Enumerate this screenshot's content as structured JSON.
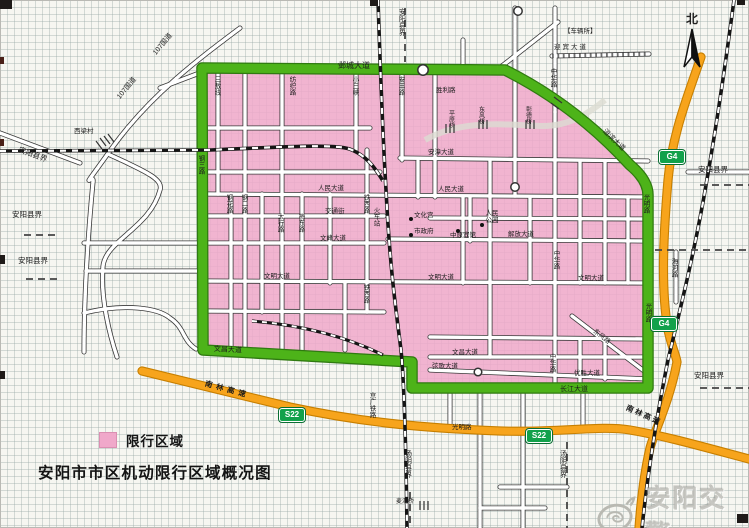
{
  "title": "安阳市市区机动限行区域概况图",
  "legend": {
    "label": "限行区域"
  },
  "watermark": {
    "text": "安阳交警"
  },
  "compass": {
    "label": "北"
  },
  "colors": {
    "restricted_pink": "#F0A8CA",
    "boundary_green": "#4DB319",
    "highway_orange": "#F7A41C",
    "shield_green": "#12A14B",
    "paper": "#F6F6F1"
  },
  "map": {
    "labels": [
      {
        "t": "邺城大道",
        "x": 338,
        "y": 62,
        "s": 8,
        "n": "road-label-yecheng-avenue"
      },
      {
        "t": "钢三路",
        "x": 197,
        "y": 155,
        "s": 6.5,
        "v": 1,
        "n": "road-label-gangsan-road"
      },
      {
        "t": "文昌大道",
        "x": 214,
        "y": 346,
        "s": 7,
        "r": 3,
        "n": "road-label-wenchang-avenue-west"
      },
      {
        "t": "长江大道",
        "x": 560,
        "y": 386,
        "s": 7,
        "n": "road-label-changjiang-avenue"
      },
      {
        "t": "光明路",
        "x": 642,
        "y": 194,
        "s": 6.5,
        "v": 1,
        "n": "road-label-guangming-road"
      },
      {
        "t": "光明路",
        "x": 644,
        "y": 303,
        "s": 6.5,
        "v": 1,
        "n": "road-label-guangming-road"
      },
      {
        "t": "洹滨大道",
        "x": 606,
        "y": 128,
        "s": 7,
        "r": 44,
        "n": "road-label-huanbin-avenue"
      },
      {
        "t": "三敖线",
        "x": 213,
        "y": 76,
        "s": 6.5,
        "v": 1,
        "n": "road-label-sanao-line"
      },
      {
        "t": "纺织路",
        "x": 288,
        "y": 76,
        "s": 6.5,
        "v": 1,
        "n": "road-label-fangzhi-road"
      },
      {
        "t": "小三峡",
        "x": 351,
        "y": 76,
        "s": 6.5,
        "v": 1,
        "n": "road-label-xiaosanxia"
      },
      {
        "t": "安丰路",
        "x": 397,
        "y": 76,
        "s": 6.5,
        "v": 1,
        "n": "road-label-anfeng-road"
      },
      {
        "t": "胜利路",
        "x": 436,
        "y": 87,
        "s": 6.5,
        "n": "road-label-shengli-road"
      },
      {
        "t": "中华路",
        "x": 549,
        "y": 68,
        "s": 6.5,
        "v": 1,
        "n": "road-label-zhonghua-road"
      },
      {
        "t": "中华路",
        "x": 552,
        "y": 250,
        "s": 6.5,
        "v": 1,
        "n": "road-label-zhonghua-road"
      },
      {
        "t": "中华路",
        "x": 548,
        "y": 353,
        "s": 6.5,
        "v": 1,
        "n": "road-label-zhonghua-road"
      },
      {
        "t": "铁西路",
        "x": 362,
        "y": 194,
        "s": 6.5,
        "v": 1,
        "n": "road-label-tiexi-road"
      },
      {
        "t": "铁西路",
        "x": 362,
        "y": 284,
        "s": 6.5,
        "v": 1,
        "n": "road-label-tiexi-road"
      },
      {
        "t": "太行路",
        "x": 276,
        "y": 213,
        "s": 6.5,
        "v": 1,
        "n": "road-label-taihang-road"
      },
      {
        "t": "梅东路",
        "x": 297,
        "y": 213,
        "s": 6.5,
        "v": 1,
        "n": "road-label-meidong-road"
      },
      {
        "t": "钢花路",
        "x": 225,
        "y": 194,
        "s": 6.5,
        "v": 1,
        "n": "road-label-ganghua-road"
      },
      {
        "t": "钢二路",
        "x": 240,
        "y": 194,
        "s": 6.5,
        "v": 1,
        "n": "road-label-ganger-road"
      },
      {
        "t": "安漳大道",
        "x": 428,
        "y": 149,
        "s": 6.5,
        "n": "road-label-anzhang-avenue"
      },
      {
        "t": "人民大道",
        "x": 438,
        "y": 186,
        "s": 6.5,
        "n": "road-label-renmin-avenue"
      },
      {
        "t": "人民大道",
        "x": 318,
        "y": 185,
        "s": 6.5,
        "n": "road-label-renmin-avenue"
      },
      {
        "t": "交通街",
        "x": 325,
        "y": 208,
        "s": 6.5,
        "n": "road-label-jiaotong-street"
      },
      {
        "t": "文峰大道",
        "x": 320,
        "y": 235,
        "s": 6.5,
        "n": "road-label-wenfeng-avenue"
      },
      {
        "t": "解放大道",
        "x": 508,
        "y": 231,
        "s": 6.5,
        "n": "road-label-jiefang-avenue"
      },
      {
        "t": "文明大道",
        "x": 264,
        "y": 273,
        "s": 6.5,
        "n": "road-label-wenming-avenue"
      },
      {
        "t": "文明大道",
        "x": 428,
        "y": 274,
        "s": 6.5,
        "n": "road-label-wenming-avenue"
      },
      {
        "t": "文明大道",
        "x": 578,
        "y": 275,
        "s": 6.5,
        "n": "road-label-wenming-avenue"
      },
      {
        "t": "文昌大道",
        "x": 452,
        "y": 349,
        "s": 6.5,
        "n": "road-label-wenchang-avenue"
      },
      {
        "t": "弦歌大道",
        "x": 432,
        "y": 363,
        "s": 6.5,
        "n": "road-label-xiange-avenue"
      },
      {
        "t": "优胜大道",
        "x": 574,
        "y": 370,
        "s": 6.5,
        "n": "road-label-yousheng-avenue"
      },
      {
        "t": "东风路",
        "x": 596,
        "y": 328,
        "s": 6.5,
        "r": 38,
        "n": "road-label-dongfeng-road"
      },
      {
        "t": "文化宫",
        "x": 414,
        "y": 212,
        "s": 6.5,
        "n": "poi-label-cultural-palace"
      },
      {
        "t": "市政府",
        "x": 414,
        "y": 228,
        "s": 6.5,
        "n": "poi-label-city-hall"
      },
      {
        "t": "中原宾馆",
        "x": 450,
        "y": 232,
        "s": 6.5,
        "n": "poi-label-zhongyuan-hotel"
      },
      {
        "t": "人民\n公园",
        "x": 484,
        "y": 210,
        "s": 6.5,
        "pre": 1,
        "n": "poi-label-peoples-park"
      },
      {
        "t": "火车站",
        "x": 372,
        "y": 207,
        "s": 6.5,
        "v": 1,
        "n": "poi-label-railway-station"
      },
      {
        "t": "海河路",
        "x": 670,
        "y": 258,
        "s": 6.5,
        "v": 1,
        "n": "road-label-haihe-road"
      },
      {
        "t": "107国道",
        "x": 152,
        "y": 52,
        "s": 7,
        "r": -50,
        "n": "road-label-g107"
      },
      {
        "t": "107国道",
        "x": 116,
        "y": 96,
        "s": 7,
        "r": -50,
        "n": "road-label-g107"
      },
      {
        "t": "西梁村",
        "x": 74,
        "y": 128,
        "s": 6.5,
        "n": "village-label-xiliangcun"
      },
      {
        "t": "安阳县界",
        "x": 20,
        "y": 146,
        "s": 7.5,
        "r": 20,
        "n": "boundary-label-anyang-county"
      },
      {
        "t": "安阳县界",
        "x": 12,
        "y": 211,
        "s": 7.5,
        "n": "boundary-label-anyang-county"
      },
      {
        "t": "安阳县界",
        "x": 18,
        "y": 257,
        "s": 7.5,
        "n": "boundary-label-anyang-county"
      },
      {
        "t": "安阳县界",
        "x": 398,
        "y": 8,
        "s": 7,
        "v": 1,
        "n": "boundary-label-anyang-county"
      },
      {
        "t": "安阳县界",
        "x": 698,
        "y": 166,
        "s": 7.5,
        "n": "boundary-label-anyang-county"
      },
      {
        "t": "安阳县界",
        "x": 694,
        "y": 372,
        "s": 7.5,
        "n": "boundary-label-anyang-county"
      },
      {
        "t": "汤阴县界",
        "x": 404,
        "y": 450,
        "s": 7,
        "v": 1,
        "n": "boundary-label-tangyin-county"
      },
      {
        "t": "汤阴县界",
        "x": 559,
        "y": 450,
        "s": 7,
        "v": 1,
        "n": "boundary-label-tangyin-county"
      },
      {
        "t": "京广铁路",
        "x": 368,
        "y": 392,
        "s": 6.5,
        "v": 1,
        "n": "railway-label-jingguang"
      },
      {
        "t": "麦洞桥",
        "x": 396,
        "y": 499,
        "s": 6,
        "n": "bridge-label-maidong"
      },
      {
        "t": "南林高速",
        "x": 206,
        "y": 380,
        "s": 7.5,
        "r": 15,
        "ls": 4,
        "b": 1,
        "n": "highway-label-nanlin-expressway"
      },
      {
        "t": "南林高速",
        "x": 628,
        "y": 404,
        "s": 7.5,
        "r": 24,
        "ls": 2,
        "b": 1,
        "n": "highway-label-nanlin-expressway"
      },
      {
        "t": "光明路",
        "x": 452,
        "y": 424,
        "s": 6.5,
        "n": "road-label-guangming-road-south"
      },
      {
        "t": "迎宾大道",
        "x": 554,
        "y": 44,
        "s": 6.5,
        "ls": 2,
        "n": "road-label-yingbin-avenue"
      },
      {
        "t": "【车辆所】",
        "x": 564,
        "y": 28,
        "s": 6.5,
        "n": "poi-label-vehicle-office"
      },
      {
        "t": "平原桥",
        "x": 447,
        "y": 110,
        "s": 6,
        "v": 1,
        "n": "bridge-label-pingyuan"
      },
      {
        "t": "东风桥",
        "x": 477,
        "y": 106,
        "s": 6,
        "v": 1,
        "n": "bridge-label-dongfeng"
      },
      {
        "t": "彰德桥",
        "x": 524,
        "y": 106,
        "s": 6,
        "v": 1,
        "n": "bridge-label-zhangde"
      }
    ],
    "shields": [
      {
        "t": "G4",
        "x": 659,
        "y": 150,
        "n": "highway-shield-g4"
      },
      {
        "t": "G4",
        "x": 651,
        "y": 317,
        "n": "highway-shield-g4"
      },
      {
        "t": "S22",
        "x": 279,
        "y": 408,
        "n": "highway-shield-s22"
      },
      {
        "t": "S22",
        "x": 526,
        "y": 429,
        "n": "highway-shield-s22"
      }
    ],
    "poi_dots": [
      [
        409,
        217
      ],
      [
        409,
        233
      ],
      [
        456,
        229
      ],
      [
        480,
        223
      ]
    ]
  }
}
